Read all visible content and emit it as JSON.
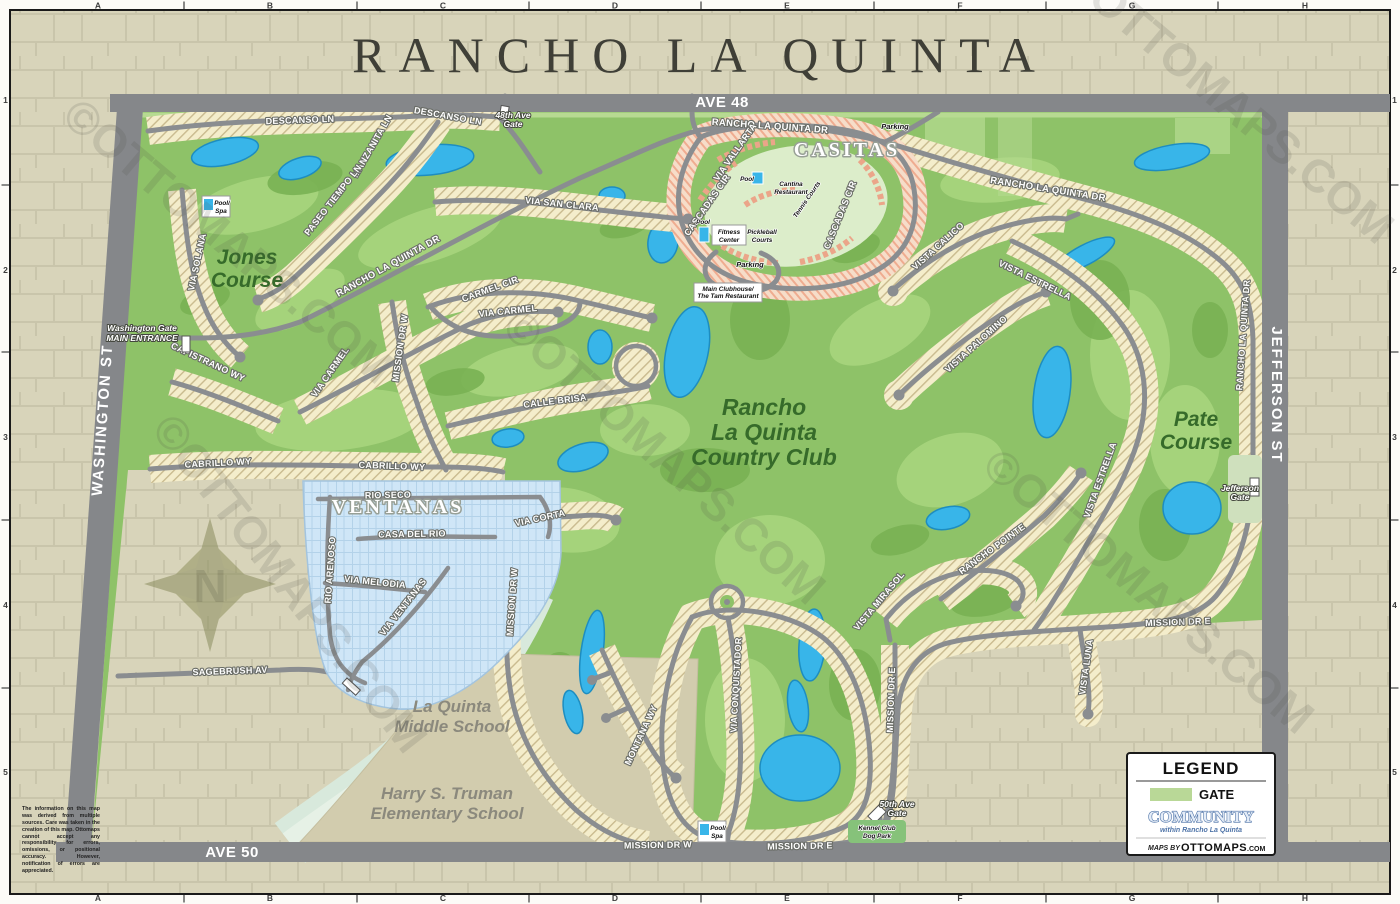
{
  "title": "RANCHO LA QUINTA",
  "grid": {
    "c0": "A",
    "c1": "B",
    "c2": "C",
    "c3": "D",
    "c4": "E",
    "c5": "F",
    "c6": "G",
    "c7": "H",
    "r0": "1",
    "r1": "2",
    "r2": "3",
    "r3": "4",
    "r4": "5"
  },
  "roads": {
    "ave48": "AVE 48",
    "ave50": "AVE 50",
    "washington": "WASHINGTON ST",
    "jefferson": "JEFFERSON ST"
  },
  "areas": {
    "casitas": "CASITAS",
    "ventanas": "VENTANAS",
    "jones1": "Jones",
    "jones2": "Course",
    "pate1": "Pate",
    "pate2": "Course",
    "club1": "Rancho",
    "club2": "La Quinta",
    "club3": "Country Club",
    "middle1": "La Quinta",
    "middle2": "Middle School",
    "elem1": "Harry S. Truman",
    "elem2": "Elementary School"
  },
  "streets": {
    "descanso1": "DESCANSO LN",
    "descanso2": "DESCANSO LN",
    "manzanita": "MANZANITA LN",
    "paseo_tiempo": "PASEO TIEMPO LN",
    "via_solana": "VIA SOLANA",
    "rlq_top": "RANCHO LA QUINTA DR",
    "rlq_mid": "RANCHO LA QUINTA DR",
    "rlq_east": "RANCHO LA QUINTA DR",
    "rlq_south": "RANCHO LA QUINTA DR",
    "via_san_clara": "VIA SAN CLARA",
    "carmel_cir": "CARMEL CIR",
    "via_carmel1": "VIA CARMEL",
    "via_carmel2": "VIA CARMEL",
    "capistrano": "CAPISTRANO WY",
    "cabrillo1": "CABRILLO WY",
    "cabrillo2": "CABRILLO WY",
    "calle_brisa": "CALLE BRISA",
    "via_corta": "VIA CORTA",
    "mission_w1": "MISSION DR W",
    "mission_w2": "MISSION DR W",
    "mission_w3": "MISSION DR W",
    "mission_e1": "MISSION DR E",
    "mission_e2": "MISSION DR E",
    "mission_e3": "MISSION DR E",
    "montana": "MONTANA WY",
    "via_conquistador": "VIA CONQUISTADOR",
    "vista_mirasol": "VISTA MIRASOL",
    "vista_luna": "VISTA LUNA",
    "via_vallarta": "VIA VALLARTA",
    "cascadas1": "CASCADAS CIR",
    "cascadas2": "CASCADAS CIR",
    "vista_calico": "VISTA CALICO",
    "vista_estrella1": "VISTA ESTRELLA",
    "vista_estrella2": "VISTA ESTRELLA",
    "vista_palomino": "VISTA PALOMINO",
    "rancho_pointe": "RANCHO POINTE",
    "rio_seco": "RIO SECO",
    "casa_del_rio": "CASA DEL RIO",
    "via_melodia": "VIA MELODIA",
    "via_ventanas": "VIA VENTANAS",
    "rio_arenoso": "RIO ARENOSO",
    "sagebrush": "SAGEBRUSH AV"
  },
  "gates": {
    "washington1": "Washington Gate",
    "washington2": "MAIN ENTRANCE",
    "g48_1": "48th Ave",
    "g48_2": "Gate",
    "jefferson1": "Jefferson",
    "jefferson2": "Gate",
    "g50_1": "50th Ave",
    "g50_2": "Gate"
  },
  "facilities": {
    "parking1": "Parking",
    "parking2": "Parking",
    "pool1": "Pool",
    "cantina1": "Cantina",
    "cantina2": "Restaurant",
    "pool2": "Pool",
    "fitness1": "Fitness",
    "fitness2": "Center",
    "pickleball1": "Pickleball",
    "pickleball2": "Courts",
    "tennis": "Tennis Courts",
    "clubhouse1": "Main Clubhouse/",
    "clubhouse2": "The Tam Restaurant",
    "pool_spa1a": "Pool/",
    "pool_spa1b": "Spa",
    "pool_spa2a": "Pool/",
    "pool_spa2b": "Spa",
    "kennel1": "Kennel Club",
    "kennel2": "Dog Park"
  },
  "legend": {
    "title": "LEGEND",
    "gate": "GATE",
    "community": "COMMUNITY",
    "community_sub": "within Rancho La Quinta",
    "maps_by": "MAPS BY",
    "brand": "OTTOMAPS",
    "brand_tld": ".COM"
  },
  "compass": "N",
  "watermark": "©OTTOMAPS.COM",
  "disclaimer": "The information on this map was derived from multiple sources. Care was taken in the creation of this map. Ottomaps cannot accept any responsibility for errors, omissions, or positional accuracy. However, notification of errors are appreciated.",
  "colors": {
    "water": "#38b5e9",
    "course_green": "#8ec268",
    "lot_cream": "#f4edcb",
    "casitas_pink": "#f3c4ad",
    "ventanas_blue": "#cfe6f7",
    "road_gray": "#8a8d90",
    "suburb_tan": "#d8d4ba",
    "gate_swatch": "#b9d897"
  }
}
